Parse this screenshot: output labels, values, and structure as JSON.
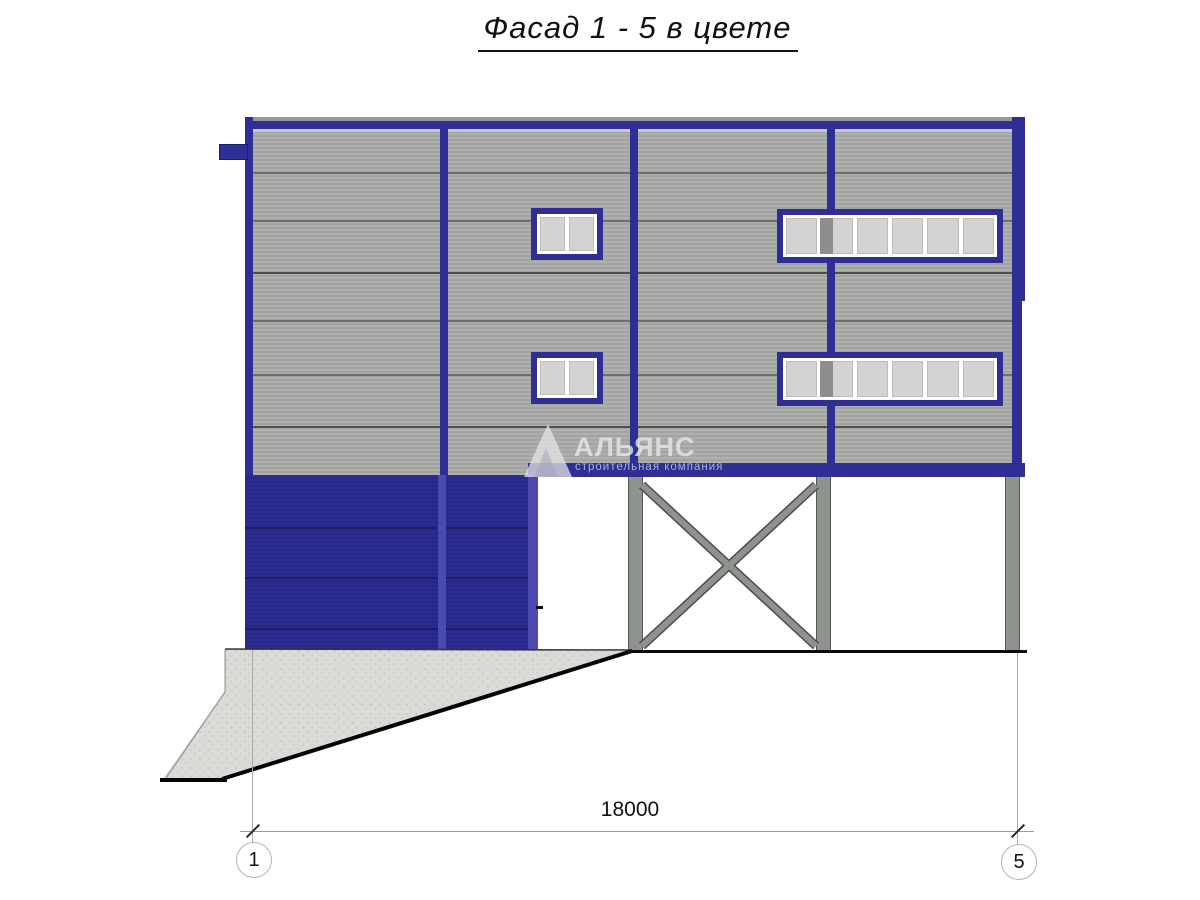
{
  "title": "Фасад 1 - 5 в цвете",
  "dimension": {
    "value": "18000"
  },
  "axes": {
    "left": "1",
    "right": "5"
  },
  "watermark": {
    "name": "АЛЬЯНС",
    "tagline": "строительная компания"
  },
  "colors": {
    "frame_blue": "#2e2e95",
    "gate_blue": "#2a2a8d",
    "siding_gray": "#a8aaa8",
    "steel_gray": "#8e938e",
    "concrete_gray": "#dadad7"
  }
}
